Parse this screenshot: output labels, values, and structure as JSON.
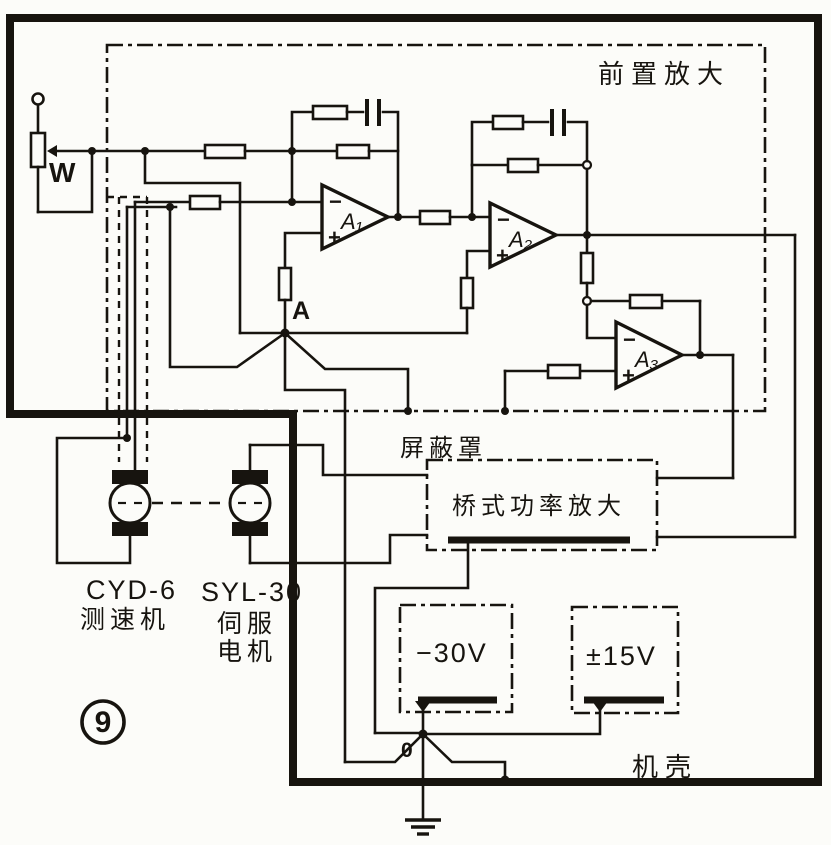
{
  "figure_number": "9",
  "preamp": {
    "label": "前置放大",
    "pot_label": "W",
    "ground_node": "A",
    "plus": "+",
    "minus": "−",
    "opamps": {
      "a1": "A₁",
      "a2": "A₂",
      "a3": "A₃"
    }
  },
  "shield": {
    "label": "屏蔽罩"
  },
  "bridge_amp": {
    "label": "桥式功率放大"
  },
  "power": {
    "neg30": "−30V",
    "pm15": "±15V",
    "ground_node": "0"
  },
  "chassis": {
    "label": "机壳"
  },
  "motors": {
    "tach": {
      "model": "CYD-6",
      "name": "测速机"
    },
    "servo": {
      "model": "SYL-30",
      "name_line1": "伺服",
      "name_line2": "电机"
    }
  }
}
